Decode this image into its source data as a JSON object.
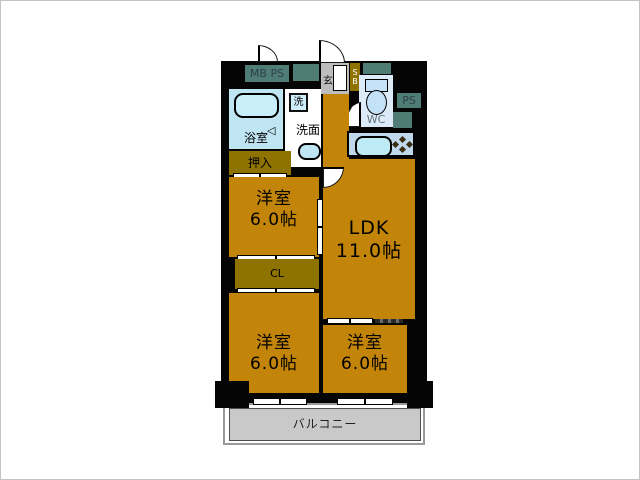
{
  "rooms": {
    "ldk": {
      "name": "LDK",
      "size": "11.0帖"
    },
    "bedroom_top": {
      "name": "洋室",
      "size": "6.0帖"
    },
    "bedroom_bottom_left": {
      "name": "洋室",
      "size": "6.0帖"
    },
    "bedroom_bottom_right": {
      "name": "洋室",
      "size": "6.0帖"
    },
    "bath": {
      "label": "浴室"
    },
    "washroom": {
      "label": "洗面"
    },
    "washer": {
      "label": "洗"
    },
    "wc": {
      "label": "WC"
    },
    "entrance": {
      "label": "玄"
    },
    "shoe_box": {
      "line1": "S",
      "line2": "B"
    },
    "meter_box": {
      "label": "MB PS"
    },
    "pipe_space": {
      "label": "PS"
    },
    "oshiire": {
      "label": "押入"
    },
    "closet": {
      "label": "CL"
    },
    "balcony": {
      "label": "バルコニー"
    }
  },
  "colors": {
    "wall": "#050505",
    "room_floor": "#C28409",
    "closet_floor": "#8E7300",
    "service_duct": "#4F7D76",
    "bath_floor": "#BFE4F2",
    "wc_floor": "#DDEBF8",
    "kitchen_counter": "#BFD8EC",
    "balcony_floor": "#C9C9C9",
    "entrance_floor": "#BDBDBD"
  }
}
